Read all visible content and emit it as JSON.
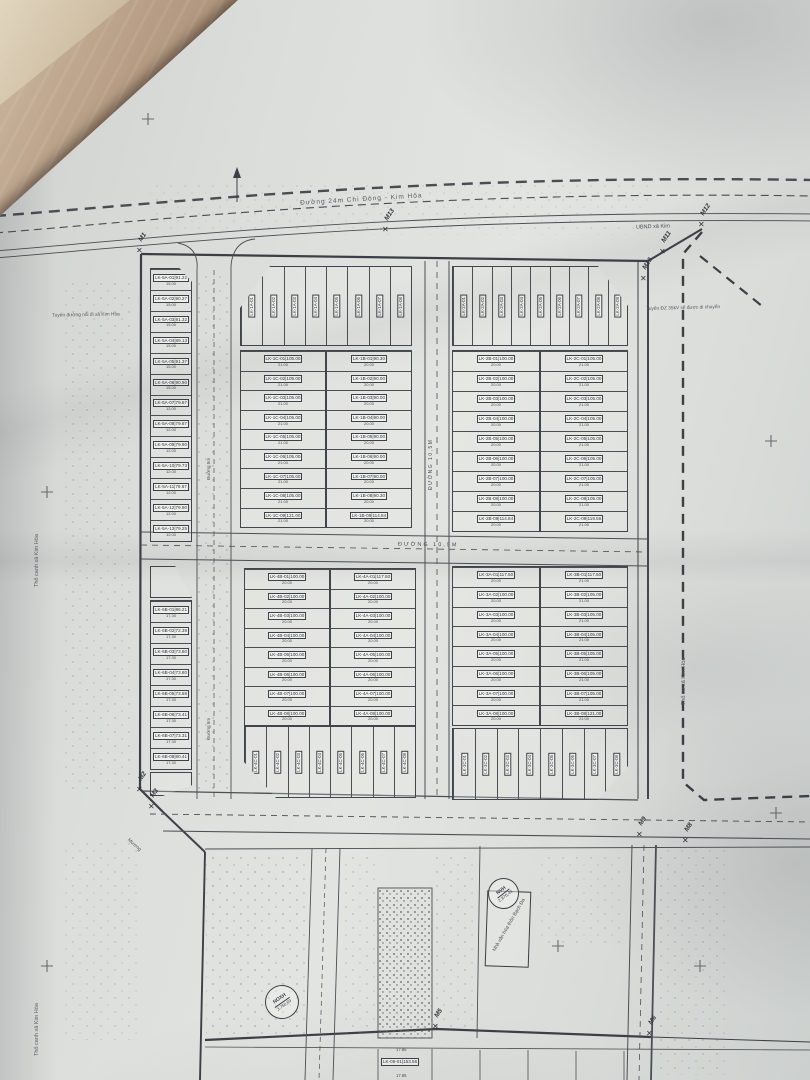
{
  "photo": {
    "surface": "fabric-backdrop",
    "colors": {
      "paper": "#dcdedb",
      "ink": "#3b4046",
      "fabric": "#9a8068"
    }
  },
  "plan": {
    "labels": {
      "road_top": "Đường 24m Chi Đông - Kim Hòa",
      "ubnd": "UBND xã Kim",
      "note_right": "Tuyến ĐZ 35kV sẽ được di chuyển",
      "note_left": "Tuyến đường nối đi xã Kim Hòa",
      "road_mid": "Đường 10,5m",
      "road_5m": "Đường 5m",
      "tho_cu": "Thổ cư xã Kim Hòa",
      "tho_canh": "Thổ canh xã Kim Hòa",
      "muong": "Mương",
      "building": "Nhà văn hóa thôn Bạch Đa"
    },
    "markers": {
      "m1": "M1",
      "m2": "M2",
      "m3": "M3",
      "m5": "M5",
      "m6": "M6",
      "m8": "M8",
      "m9": "M9",
      "m10": "M10",
      "m11": "M11",
      "m12": "M12",
      "m13": "M13"
    },
    "stamps": {
      "nvh": {
        "line1": "NVH",
        "line2": "2.876,43"
      },
      "noxh": {
        "line1": "NOXH",
        "line2": "3.750,69"
      }
    },
    "bottom_strip": {
      "lot_label": "LK-06-01|153.56",
      "w": "17.86"
    },
    "blocks": {
      "lk5a": {
        "lots": [
          {
            "label": "LK-5A-01|91.22",
            "w": "15.00"
          },
          {
            "label": "LK-5A-02|90.27",
            "w": "15.00"
          },
          {
            "label": "LK-5A-03|91.32",
            "w": "15.00"
          },
          {
            "label": "LK-5A-04|89.13",
            "w": "15.00"
          },
          {
            "label": "LK-5A-05|91.37",
            "w": "15.00"
          },
          {
            "label": "LK-5A-06|90.90",
            "w": "15.00"
          },
          {
            "label": "LK-5A-07|79.87",
            "w": "12.00"
          },
          {
            "label": "LK-5A-08|79.87",
            "w": "12.00"
          },
          {
            "label": "LK-5A-09|79.90",
            "w": "12.00"
          },
          {
            "label": "LK-5A-10|79.73",
            "w": "12.00"
          },
          {
            "label": "LK-5A-11|79.67",
            "w": "12.00"
          },
          {
            "label": "LK-5A-12|79.90",
            "w": "12.00"
          },
          {
            "label": "LK-5A-13|79.25",
            "w": "12.00"
          }
        ]
      },
      "lk6b": {
        "lots": [
          {
            "label": "LK-6B-01|86.21",
            "w": "17.30"
          },
          {
            "label": "LK-6B-02|72.39",
            "w": "17.30"
          },
          {
            "label": "LK-6B-03|73.80",
            "w": "17.30"
          },
          {
            "label": "LK-6B-04|73.80",
            "w": "17.30"
          },
          {
            "label": "LK-6B-05|73.58",
            "w": "17.30"
          },
          {
            "label": "LK-6B-06|73.41",
            "w": "17.30"
          },
          {
            "label": "LK-6B-07|73.31",
            "w": "17.30"
          },
          {
            "label": "LK-6B-08|80.41",
            "w": "17.30"
          }
        ]
      },
      "lk1a": {
        "lots": [
          {
            "label": "LK-1A-01"
          },
          {
            "label": "LK-1A-02"
          },
          {
            "label": "LK-1A-03"
          },
          {
            "label": "LK-1A-04"
          },
          {
            "label": "LK-1A-05"
          },
          {
            "label": "LK-1A-06"
          },
          {
            "label": "LK-1A-07"
          },
          {
            "label": "LK-1A-08"
          }
        ]
      },
      "lk2a": {
        "lots": [
          {
            "label": "LK-2A-01"
          },
          {
            "label": "LK-2A-02"
          },
          {
            "label": "LK-2A-03"
          },
          {
            "label": "LK-2A-04"
          },
          {
            "label": "LK-2A-05"
          },
          {
            "label": "LK-2A-06"
          },
          {
            "label": "LK-2A-07"
          },
          {
            "label": "LK-2A-08"
          },
          {
            "label": "LK-2A-09"
          }
        ]
      },
      "lk1c": {
        "lots": [
          {
            "label": "LK-1C-01|105.00",
            "w": "21.00"
          },
          {
            "label": "LK-1C-02|105.00",
            "w": "21.00"
          },
          {
            "label": "LK-1C-03|105.00",
            "w": "21.00"
          },
          {
            "label": "LK-1C-04|105.00",
            "w": "21.00"
          },
          {
            "label": "LK-1C-05|105.00",
            "w": "21.00"
          },
          {
            "label": "LK-1C-06|105.00",
            "w": "21.00"
          },
          {
            "label": "LK-1C-07|105.00",
            "w": "21.00"
          },
          {
            "label": "LK-1C-08|105.00",
            "w": "21.00"
          },
          {
            "label": "LK-1C-09|121.00",
            "w": "21.00"
          }
        ]
      },
      "lk1b": {
        "lots": [
          {
            "label": "LK-1B-01|90.30",
            "w": "20.00"
          },
          {
            "label": "LK-1B-02|90.00",
            "w": "20.00"
          },
          {
            "label": "LK-1B-03|90.00",
            "w": "20.00"
          },
          {
            "label": "LK-1B-04|90.00",
            "w": "20.00"
          },
          {
            "label": "LK-1B-05|90.00",
            "w": "20.00"
          },
          {
            "label": "LK-1B-06|90.00",
            "w": "20.00"
          },
          {
            "label": "LK-1B-07|90.00",
            "w": "20.00"
          },
          {
            "label": "LK-1B-08|90.30",
            "w": "20.00"
          },
          {
            "label": "LK-1B-09|114.84",
            "w": "20.00"
          }
        ]
      },
      "lk2b": {
        "lots": [
          {
            "label": "LK-2B-01|100.00",
            "w": "20.00"
          },
          {
            "label": "LK-2B-02|100.00",
            "w": "20.00"
          },
          {
            "label": "LK-2B-03|100.00",
            "w": "20.00"
          },
          {
            "label": "LK-2B-04|100.00",
            "w": "20.00"
          },
          {
            "label": "LK-2B-05|100.00",
            "w": "20.00"
          },
          {
            "label": "LK-2B-06|100.00",
            "w": "20.00"
          },
          {
            "label": "LK-2B-07|100.00",
            "w": "20.00"
          },
          {
            "label": "LK-2B-08|100.00",
            "w": "20.00"
          },
          {
            "label": "LK-2B-09|114.84",
            "w": "20.00"
          }
        ]
      },
      "lk2c": {
        "lots": [
          {
            "label": "LK-2C-01|105.00",
            "w": "21.00"
          },
          {
            "label": "LK-2C-02|105.00",
            "w": "21.00"
          },
          {
            "label": "LK-2C-03|105.00",
            "w": "21.00"
          },
          {
            "label": "LK-2C-04|105.00",
            "w": "21.00"
          },
          {
            "label": "LK-2C-05|105.00",
            "w": "21.00"
          },
          {
            "label": "LK-2C-06|105.00",
            "w": "21.00"
          },
          {
            "label": "LK-2C-07|105.00",
            "w": "21.00"
          },
          {
            "label": "LK-2C-08|105.00",
            "w": "21.00"
          },
          {
            "label": "LK-2C-09|119.56",
            "w": "21.00"
          }
        ]
      },
      "lk4b": {
        "lots": [
          {
            "label": "LK-4B-01|100.00",
            "w": "20.00"
          },
          {
            "label": "LK-4B-02|100.00",
            "w": "20.00"
          },
          {
            "label": "LK-4B-03|100.00",
            "w": "20.00"
          },
          {
            "label": "LK-4B-04|100.00",
            "w": "20.00"
          },
          {
            "label": "LK-4B-05|100.00",
            "w": "20.00"
          },
          {
            "label": "LK-4B-06|100.00",
            "w": "20.00"
          },
          {
            "label": "LK-4B-07|100.00",
            "w": "20.00"
          },
          {
            "label": "LK-4B-08|100.00",
            "w": "20.00"
          }
        ]
      },
      "lk4a": {
        "lots": [
          {
            "label": "LK-4A-01|117.50",
            "w": "20.00"
          },
          {
            "label": "LK-4A-02|100.00",
            "w": "20.00"
          },
          {
            "label": "LK-4A-03|100.00",
            "w": "20.00"
          },
          {
            "label": "LK-4A-04|100.00",
            "w": "20.00"
          },
          {
            "label": "LK-4A-05|100.00",
            "w": "20.00"
          },
          {
            "label": "LK-4A-06|100.00",
            "w": "20.00"
          },
          {
            "label": "LK-4A-07|100.00",
            "w": "20.00"
          },
          {
            "label": "LK-4A-08|100.00",
            "w": "20.00"
          }
        ]
      },
      "lk3a": {
        "lots": [
          {
            "label": "LK-3A-01|117.50",
            "w": "20.00"
          },
          {
            "label": "LK-3A-02|100.00",
            "w": "20.00"
          },
          {
            "label": "LK-3A-03|100.00",
            "w": "20.00"
          },
          {
            "label": "LK-3A-04|100.00",
            "w": "20.00"
          },
          {
            "label": "LK-3A-05|100.00",
            "w": "20.00"
          },
          {
            "label": "LK-3A-06|100.00",
            "w": "20.00"
          },
          {
            "label": "LK-3A-07|100.00",
            "w": "20.00"
          },
          {
            "label": "LK-3A-08|100.00",
            "w": "20.00"
          }
        ]
      },
      "lk3b": {
        "lots": [
          {
            "label": "LK-3B-01|117.50",
            "w": "21.00"
          },
          {
            "label": "LK-3B-02|105.00",
            "w": "21.00"
          },
          {
            "label": "LK-3B-03|105.00",
            "w": "21.00"
          },
          {
            "label": "LK-3B-04|105.00",
            "w": "21.00"
          },
          {
            "label": "LK-3B-05|105.00",
            "w": "21.00"
          },
          {
            "label": "LK-3B-06|105.00",
            "w": "21.00"
          },
          {
            "label": "LK-3B-07|105.00",
            "w": "21.00"
          },
          {
            "label": "LK-3B-08|121.00",
            "w": "21.00"
          }
        ]
      },
      "lk4c": {
        "lots": [
          {
            "label": "LK-4C-01"
          },
          {
            "label": "LK-4C-02"
          },
          {
            "label": "LK-4C-03"
          },
          {
            "label": "LK-4C-04"
          },
          {
            "label": "LK-4C-05"
          },
          {
            "label": "LK-4C-06"
          },
          {
            "label": "LK-4C-07"
          },
          {
            "label": "LK-4C-08"
          }
        ]
      },
      "lk3c": {
        "lots": [
          {
            "label": "LK-3C-01"
          },
          {
            "label": "LK-3C-02"
          },
          {
            "label": "LK-3C-03"
          },
          {
            "label": "LK-3C-04"
          },
          {
            "label": "LK-3C-05"
          },
          {
            "label": "LK-3C-06"
          },
          {
            "label": "LK-3C-07"
          },
          {
            "label": "LK-3C-08"
          }
        ]
      }
    }
  }
}
